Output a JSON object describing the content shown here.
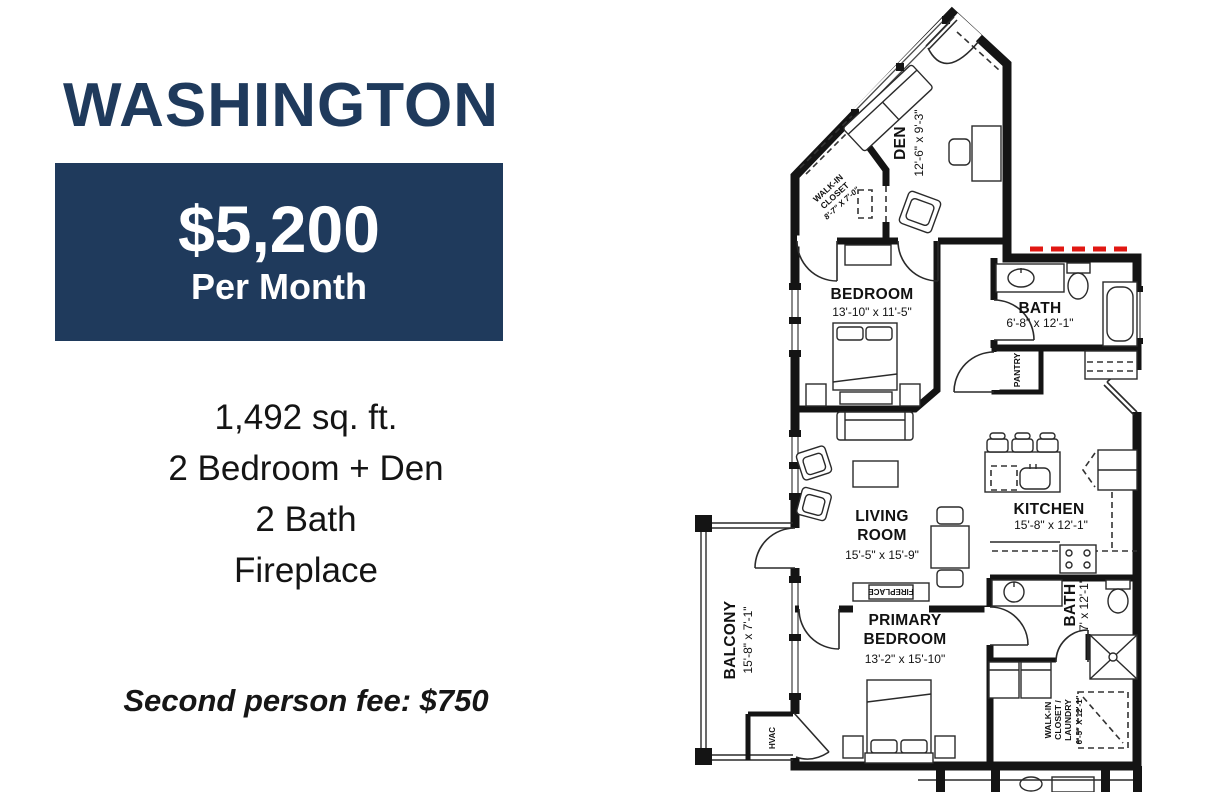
{
  "panel": {
    "title": "WASHINGTON",
    "price": "$5,200",
    "price_period": "Per Month",
    "specs": [
      "1,492 sq. ft.",
      "2 Bedroom + Den",
      "2 Bath",
      "Fireplace"
    ],
    "fee_label": "Second person fee:",
    "fee_value": "$750",
    "colors": {
      "navy": "#1f3a5c",
      "text": "#141414",
      "white": "#ffffff"
    }
  },
  "floorplan": {
    "colors": {
      "wall": "#141414",
      "fire_rated_red": "#e11712"
    },
    "rooms": {
      "walk_in_closet": {
        "line1": "WALK-IN",
        "line2": "CLOSET",
        "dims": "8'-7\" X 7'-0\""
      },
      "den": {
        "name": "DEN",
        "dims": "12'-6\" x 9'-3\""
      },
      "bedroom": {
        "name": "BEDROOM",
        "dims": "13'-10\" x 11'-5\""
      },
      "bath1": {
        "name": "BATH",
        "dims": "6'-8\" x 12'-1\""
      },
      "pantry": {
        "name": "PANTRY"
      },
      "kitchen": {
        "name": "KITCHEN",
        "dims": "15'-8\" x 12'-1\""
      },
      "living_room": {
        "line1": "LIVING",
        "line2": "ROOM",
        "dims": "15'-5\" x 15'-9\""
      },
      "balcony": {
        "name": "BALCONY",
        "dims": "15'-8\" x 7'-1\""
      },
      "fireplace": {
        "name": "FIREPLACE"
      },
      "primary_bedroom": {
        "line1": "PRIMARY",
        "line2": "BEDROOM",
        "dims": "13'-2\" x 15'-10\""
      },
      "bath2": {
        "name": "BATH",
        "dims": "7' x 12'-1\""
      },
      "wic_laundry": {
        "line1": "WALK-IN",
        "line2": "CLOSET /",
        "line3": "LAUNDRY",
        "dims": "6'-5\" X 12'-1\""
      },
      "hvac": {
        "name": "HVAC"
      }
    }
  }
}
